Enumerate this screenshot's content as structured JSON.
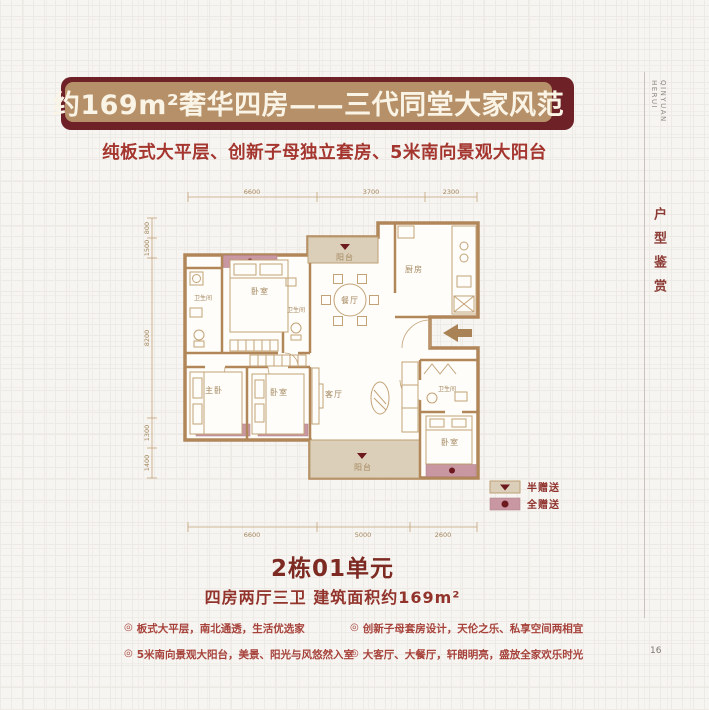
{
  "header": {
    "banner_title": "约169m²奢华四房——三代同堂大家风范",
    "subtitle": "纯板式大平层、创新子母独立套房、5米南向景观大阳台"
  },
  "unit": {
    "title": "2栋01单元",
    "spec": "四房两厅三卫 建筑面积约169m²"
  },
  "features_bullet": "◎",
  "features": [
    "板式大平层，南北通透，生活优选家",
    "创新子母套房设计，天伦之乐、私享空间两相宜",
    "5米南向景观大阳台，美景、阳光与风悠然入室",
    "大客厅、大餐厅，轩朗明亮，盛放全家欢乐时光"
  ],
  "sidebar": {
    "brand": "QINYUAN HERUI",
    "section": "户型鉴赏",
    "page_number": "16"
  },
  "floorplan": {
    "rooms": {
      "balcony_top": "阳台",
      "kitchen": "厨房",
      "dining": "餐厅",
      "bath_left": "卫生间",
      "bed_top": "卧室",
      "bath_mid": "卫生间",
      "master": "主卧",
      "bed_bottom": "卧室",
      "living": "客厅",
      "bath_suite": "卫生间",
      "bed_suite": "卧室",
      "balcony_bottom": "阳台"
    },
    "dims_top": [
      "6600",
      "3700",
      "2300"
    ],
    "dims_left": [
      "800",
      "1500",
      "8200",
      "1300",
      "1400"
    ],
    "dims_bottom": [
      "6600",
      "5000",
      "2600"
    ],
    "legend": [
      {
        "label": "半赠送",
        "marker": "triangle",
        "swatch": "#dccfb9"
      },
      {
        "label": "全赠送",
        "marker": "dot",
        "swatch": "#c997a1"
      }
    ],
    "colors": {
      "wall": "#b1875a",
      "balcony_fill": "#dccfb9",
      "gift_fill": "#c997a1",
      "marker": "#6d1a1f",
      "banner_tan": "#b69068",
      "banner_maroon": "#6e2227",
      "accent_red": "#a4352f",
      "dark_red": "#7c2a22"
    }
  }
}
